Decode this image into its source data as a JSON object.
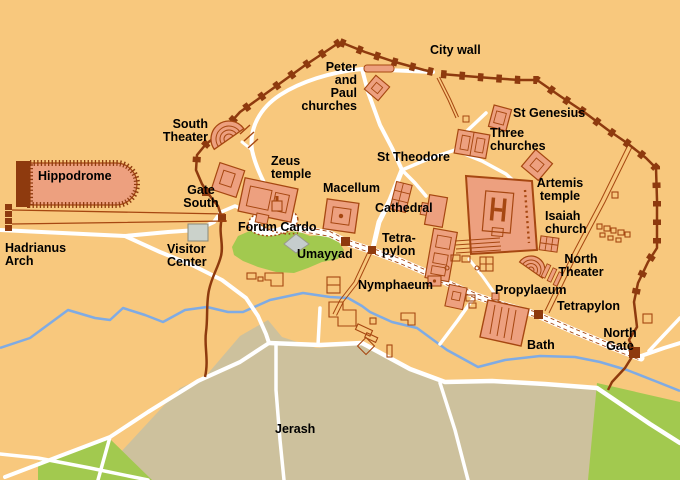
{
  "map": {
    "title": "Jerash archaeological site map",
    "place_name": "Jerash",
    "colors": {
      "background": "#F8C87D",
      "building_fill": "#EDA07F",
      "building_outline": "#A64711",
      "city_wall": "#8E3A0E",
      "road": "#FFFFFF",
      "river": "#7FABE4",
      "modern_town": "#CDC19D",
      "green_area": "#A2C94F",
      "visitor_center_fill": "#CBD2CB",
      "label_color": "#000000"
    },
    "labels": {
      "hippodrome": {
        "text": "Hippodrome"
      },
      "city_wall": {
        "text": "City wall"
      },
      "south_theater": {
        "text": "South\nTheater"
      },
      "zeus_temple": {
        "text": "Zeus\ntemple"
      },
      "gate_south": {
        "text": "Gate\nSouth"
      },
      "forum_cardo": {
        "text": "Forum Cardo"
      },
      "hadrianus_arch": {
        "text": "Hadrianus\nArch"
      },
      "visitor_center": {
        "text": "Visitor\nCenter"
      },
      "umayyad": {
        "text": "Umayyad"
      },
      "macellum": {
        "text": "Macellum"
      },
      "cathedral": {
        "text": "Cathedral"
      },
      "tetrapylon_south": {
        "text": "Tetra-\npylon"
      },
      "nymphaeum": {
        "text": "Nymphaeum"
      },
      "st_theodore": {
        "text": "St Theodore"
      },
      "peter_paul": {
        "text": "Peter\nand\nPaul\nchurches"
      },
      "st_genesius": {
        "text": "St Genesius"
      },
      "three_churches": {
        "text": "Three\nchurches"
      },
      "artemis_temple": {
        "text": "Artemis\ntemple"
      },
      "isaiah_church": {
        "text": "Isaiah\nchurch"
      },
      "north_theater": {
        "text": "North\nTheater"
      },
      "propylaeum": {
        "text": "Propylaeum"
      },
      "tetrapylon_north": {
        "text": "Tetrapylon"
      },
      "north_gate": {
        "text": "North\nGate"
      },
      "bath": {
        "text": "Bath"
      },
      "jerash": {
        "text": "Jerash"
      }
    }
  }
}
